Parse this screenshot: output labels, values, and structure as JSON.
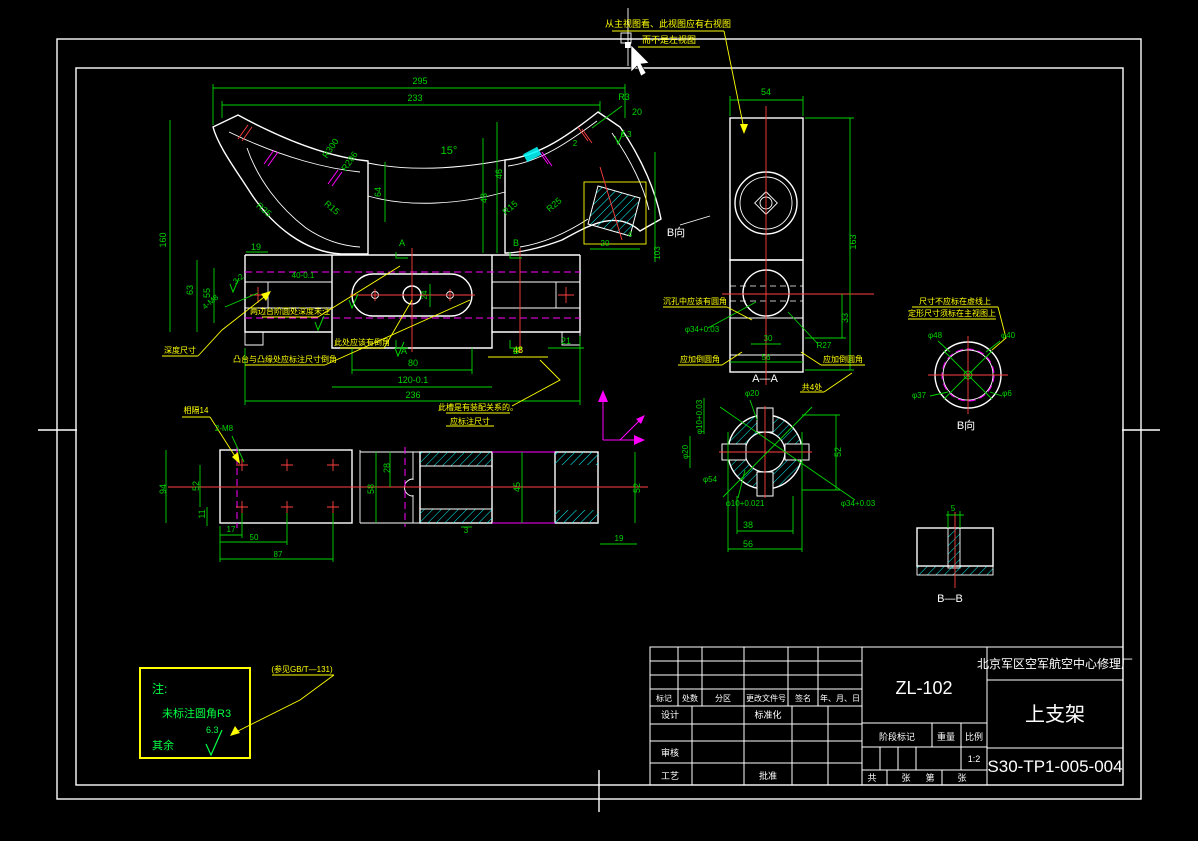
{
  "colors": {
    "background": "#000000",
    "outline": "#ffffff",
    "dimension": "#00d400",
    "review_highlight": "#ffff00",
    "hatch": "#00ffff",
    "centerline": "#ff4040",
    "phantom": "#ff00ff"
  },
  "title_block": {
    "company": "北京军区空军航空中心修理厂",
    "part_name": "上支架",
    "drawing_no": "S30-TP1-005-004",
    "model": "ZL-102",
    "columns": [
      "标记",
      "处数",
      "分区",
      "更改文件号",
      "签名",
      "年、月、日"
    ],
    "roles": {
      "design": "设计",
      "standardization": "标准化",
      "check": "审核",
      "process": "工艺",
      "approve": "批准"
    },
    "stage_label": "阶段标记",
    "weight_label": "重量",
    "scale_label": "比例",
    "scale_value": "1:2",
    "sheet_total_label": "共",
    "sheet_unit1": "张",
    "sheet_no_label": "第",
    "sheet_unit2": "张"
  },
  "note_box": {
    "heading": "注:",
    "line1": "未标注圆角R3",
    "line2": "其余",
    "finish_value": "6.3"
  },
  "drawing": {
    "view_names": [
      "B向",
      "A—A",
      "B向",
      "B—B"
    ],
    "labels": [
      {
        "t": "295",
        "x": 420,
        "y": 84
      },
      {
        "t": "233",
        "x": 415,
        "y": 101
      },
      {
        "t": "R300",
        "x": 333,
        "y": 150,
        "r": -55
      },
      {
        "t": "R286",
        "x": 352,
        "y": 163,
        "r": -55
      },
      {
        "t": "15°",
        "x": 449,
        "y": 154,
        "s": 11
      },
      {
        "t": "64",
        "x": 381,
        "y": 192,
        "r": -90
      },
      {
        "t": "46",
        "x": 502,
        "y": 174,
        "r": -90
      },
      {
        "t": "43",
        "x": 487,
        "y": 198,
        "r": -90
      },
      {
        "t": "R35",
        "x": 262,
        "y": 212,
        "r": 40
      },
      {
        "t": "R15",
        "x": 330,
        "y": 210,
        "r": 40
      },
      {
        "t": "R15",
        "x": 512,
        "y": 210,
        "r": -40
      },
      {
        "t": "R25",
        "x": 556,
        "y": 207,
        "r": -40
      },
      {
        "t": "R3",
        "x": 624,
        "y": 100
      },
      {
        "t": "20",
        "x": 637,
        "y": 115
      },
      {
        "t": "2",
        "x": 575,
        "y": 146,
        "s": 8
      },
      {
        "t": "19",
        "x": 256,
        "y": 250
      },
      {
        "t": "160",
        "x": 166,
        "y": 240,
        "r": -90
      },
      {
        "t": "63",
        "x": 193,
        "y": 290,
        "r": -90
      },
      {
        "t": "55",
        "x": 210,
        "y": 293,
        "r": -90
      },
      {
        "t": "3.2",
        "x": 240,
        "y": 281,
        "r": -40,
        "s": 8
      },
      {
        "t": "4-M8",
        "x": 212,
        "y": 304,
        "r": -40,
        "s": 8
      },
      {
        "t": "40-0.1",
        "x": 303,
        "y": 278,
        "s": 8
      },
      {
        "t": "24",
        "x": 427,
        "y": 295,
        "r": -90,
        "s": 8
      },
      {
        "t": "80",
        "x": 413,
        "y": 366
      },
      {
        "t": "120-0.1",
        "x": 413,
        "y": 383
      },
      {
        "t": "236",
        "x": 413,
        "y": 398
      },
      {
        "t": "48",
        "x": 518,
        "y": 353,
        "c": "y"
      },
      {
        "t": "21",
        "x": 566,
        "y": 344
      },
      {
        "t": "6.3",
        "x": 626,
        "y": 137,
        "s": 8
      },
      {
        "t": "20",
        "x": 605,
        "y": 246,
        "s": 8
      },
      {
        "t": "103",
        "x": 660,
        "y": 253,
        "r": -90,
        "s": 8
      },
      {
        "t": "4",
        "x": 630,
        "y": 237,
        "s": 8
      },
      {
        "t": "B向",
        "x": 676,
        "y": 236,
        "c": "w",
        "s": 11,
        "n": "view-label-b-direction"
      },
      {
        "t": "A",
        "x": 402,
        "y": 246,
        "s": 9
      },
      {
        "t": "A",
        "x": 404,
        "y": 354,
        "s": 9
      },
      {
        "t": "B",
        "x": 516,
        "y": 246,
        "s": 9
      },
      {
        "t": "B",
        "x": 516,
        "y": 354,
        "s": 9
      },
      {
        "t": "54",
        "x": 766,
        "y": 95
      },
      {
        "t": "163",
        "x": 856,
        "y": 242,
        "r": -90
      },
      {
        "t": "33",
        "x": 848,
        "y": 318,
        "r": -90
      },
      {
        "t": "R27",
        "x": 824,
        "y": 348,
        "s": 8
      },
      {
        "t": "30",
        "x": 768,
        "y": 341,
        "s": 8
      },
      {
        "t": "56",
        "x": 766,
        "y": 360,
        "s": 8
      },
      {
        "t": "A—A",
        "x": 765,
        "y": 382,
        "c": "w",
        "s": 11,
        "n": "view-label-section-aa"
      },
      {
        "t": "φ34+0.03",
        "x": 702,
        "y": 332,
        "s": 8
      },
      {
        "t": "φ20",
        "x": 752,
        "y": 396,
        "s": 8
      },
      {
        "t": "φ10+0.03",
        "x": 702,
        "y": 417,
        "r": -90,
        "s": 8
      },
      {
        "t": "φ20",
        "x": 688,
        "y": 452,
        "r": -90,
        "s": 8
      },
      {
        "t": "φ54",
        "x": 710,
        "y": 482,
        "s": 8
      },
      {
        "t": "φ10+0.021",
        "x": 745,
        "y": 506,
        "s": 8
      },
      {
        "t": "φ34+0.03",
        "x": 858,
        "y": 506,
        "s": 8
      },
      {
        "t": "52",
        "x": 841,
        "y": 452,
        "r": -90
      },
      {
        "t": "38",
        "x": 748,
        "y": 528
      },
      {
        "t": "56",
        "x": 748,
        "y": 547
      },
      {
        "t": "φ48",
        "x": 935,
        "y": 338,
        "s": 8
      },
      {
        "t": "φ40",
        "x": 1008,
        "y": 338,
        "s": 8
      },
      {
        "t": "φ37",
        "x": 919,
        "y": 398,
        "s": 8
      },
      {
        "t": "φ6",
        "x": 1007,
        "y": 396,
        "s": 8
      },
      {
        "t": "B向",
        "x": 966,
        "y": 429,
        "c": "w",
        "s": 11,
        "n": "view-label-b-direction-2"
      },
      {
        "t": "5",
        "x": 953,
        "y": 511,
        "s": 8
      },
      {
        "t": "B—B",
        "x": 950,
        "y": 602,
        "c": "w",
        "s": 11,
        "n": "view-label-section-bb"
      },
      {
        "t": "2-M8",
        "x": 224,
        "y": 431,
        "s": 8
      },
      {
        "t": "94",
        "x": 166,
        "y": 489,
        "r": -90
      },
      {
        "t": "52",
        "x": 199,
        "y": 486,
        "r": -90
      },
      {
        "t": "11",
        "x": 205,
        "y": 514,
        "r": -90
      },
      {
        "t": "17",
        "x": 231,
        "y": 532,
        "s": 8
      },
      {
        "t": "50",
        "x": 254,
        "y": 540,
        "s": 8
      },
      {
        "t": "87",
        "x": 278,
        "y": 557,
        "s": 8
      },
      {
        "t": "28",
        "x": 390,
        "y": 468,
        "r": -90
      },
      {
        "t": "58",
        "x": 374,
        "y": 489,
        "r": -90
      },
      {
        "t": "45",
        "x": 520,
        "y": 487,
        "r": -90
      },
      {
        "t": "52",
        "x": 640,
        "y": 488,
        "r": -90
      },
      {
        "t": "19",
        "x": 619,
        "y": 541,
        "s": 8
      },
      {
        "t": "3",
        "x": 466,
        "y": 533,
        "s": 8
      }
    ],
    "annotations": [
      {
        "t": "从主视图看、此视图应有右视图",
        "x": 668,
        "y": 27,
        "s": 9
      },
      {
        "t": "而不是左视图",
        "x": 669,
        "y": 43,
        "s": 9
      },
      {
        "t": "尺寸不应标在虚线上",
        "x": 955,
        "y": 304,
        "s": 8
      },
      {
        "t": "定形尺寸须标在主视图上",
        "x": 952,
        "y": 316,
        "s": 8
      },
      {
        "t": "沉孔中应该有圆角",
        "x": 695,
        "y": 304,
        "s": 8
      },
      {
        "t": "应加倒圆角",
        "x": 700,
        "y": 362,
        "s": 8
      },
      {
        "t": "应加倒圆角",
        "x": 843,
        "y": 362,
        "s": 8
      },
      {
        "t": "此槽是有装配关系的。",
        "x": 478,
        "y": 410,
        "s": 8
      },
      {
        "t": "应标注尺寸",
        "x": 470,
        "y": 424,
        "s": 8
      },
      {
        "t": "深度尺寸",
        "x": 180,
        "y": 353,
        "s": 8
      },
      {
        "t": "两边台阶圆处深度未注",
        "x": 290,
        "y": 314,
        "s": 8
      },
      {
        "t": "此处应该有倒角",
        "x": 362,
        "y": 345,
        "s": 8
      },
      {
        "t": "凸台与凸缘处应标注尺寸倒角",
        "x": 285,
        "y": 362,
        "s": 8
      },
      {
        "t": "相隔14",
        "x": 196,
        "y": 413,
        "s": 8
      },
      {
        "t": "(参见GB/T—131)",
        "x": 302,
        "y": 672,
        "s": 8
      },
      {
        "t": "共4处",
        "x": 812,
        "y": 390,
        "s": 8
      }
    ]
  }
}
